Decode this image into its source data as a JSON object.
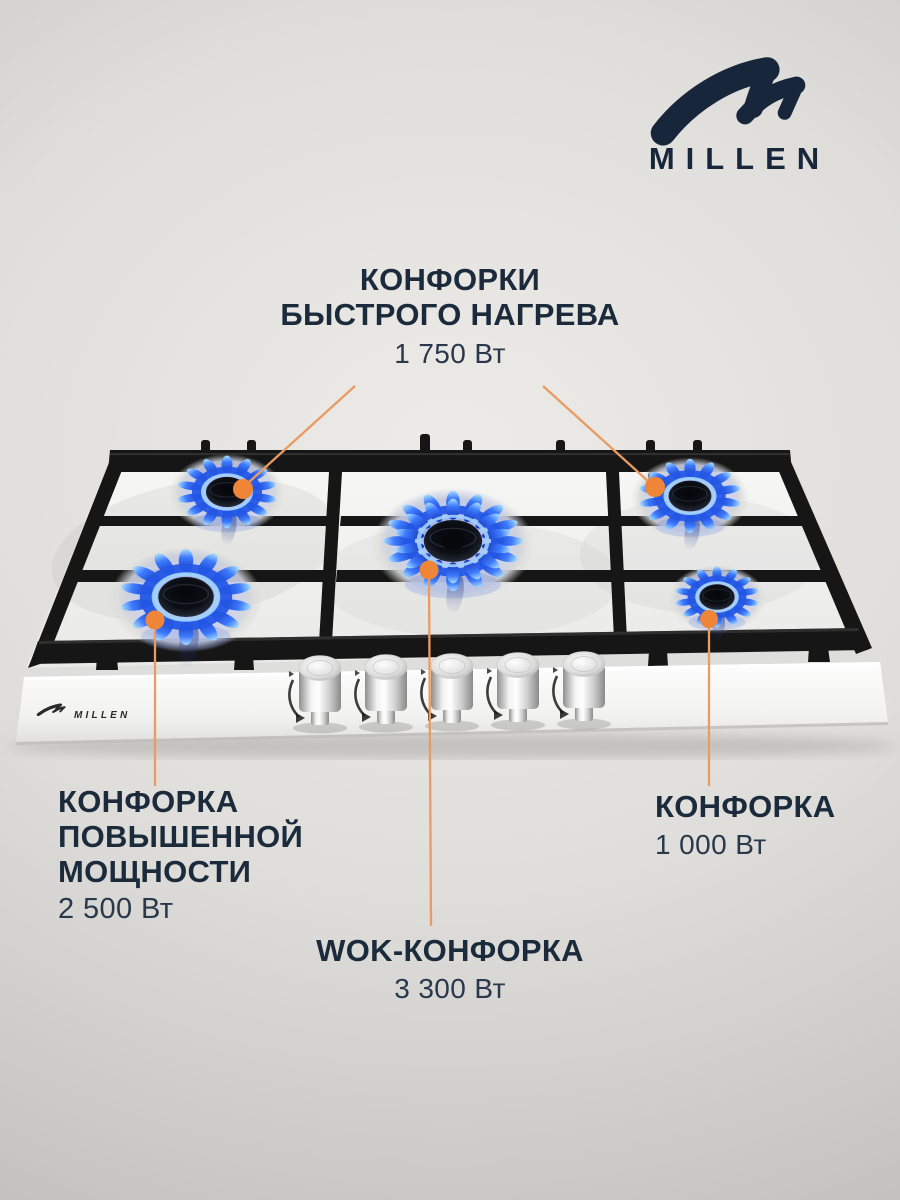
{
  "brand": {
    "wordmark": "MILLEN",
    "logo_color": "#18263B"
  },
  "hob": {
    "panel_wordmark": "MILLEN",
    "burner_count": 5,
    "knob_count": 5
  },
  "accent": {
    "dot_color": "#EE8537",
    "line_color": "#EA9B61",
    "text_color": "#1B2B3C"
  },
  "callouts": {
    "fast": {
      "line1": "КОНФОРКИ",
      "line2": "БЫСТРОГО НАГРЕВА",
      "power": "1 750 Вт"
    },
    "high_power": {
      "line1": "КОНФОРКА",
      "line2": "ПОВЫШЕННОЙ",
      "line3": "МОЩНОСТИ",
      "power": "2 500 Вт"
    },
    "wok": {
      "title": "WOK-КОНФОРКА",
      "power": "3 300 Вт"
    },
    "standard": {
      "title": "КОНФОРКА",
      "power": "1 000 Вт"
    }
  }
}
